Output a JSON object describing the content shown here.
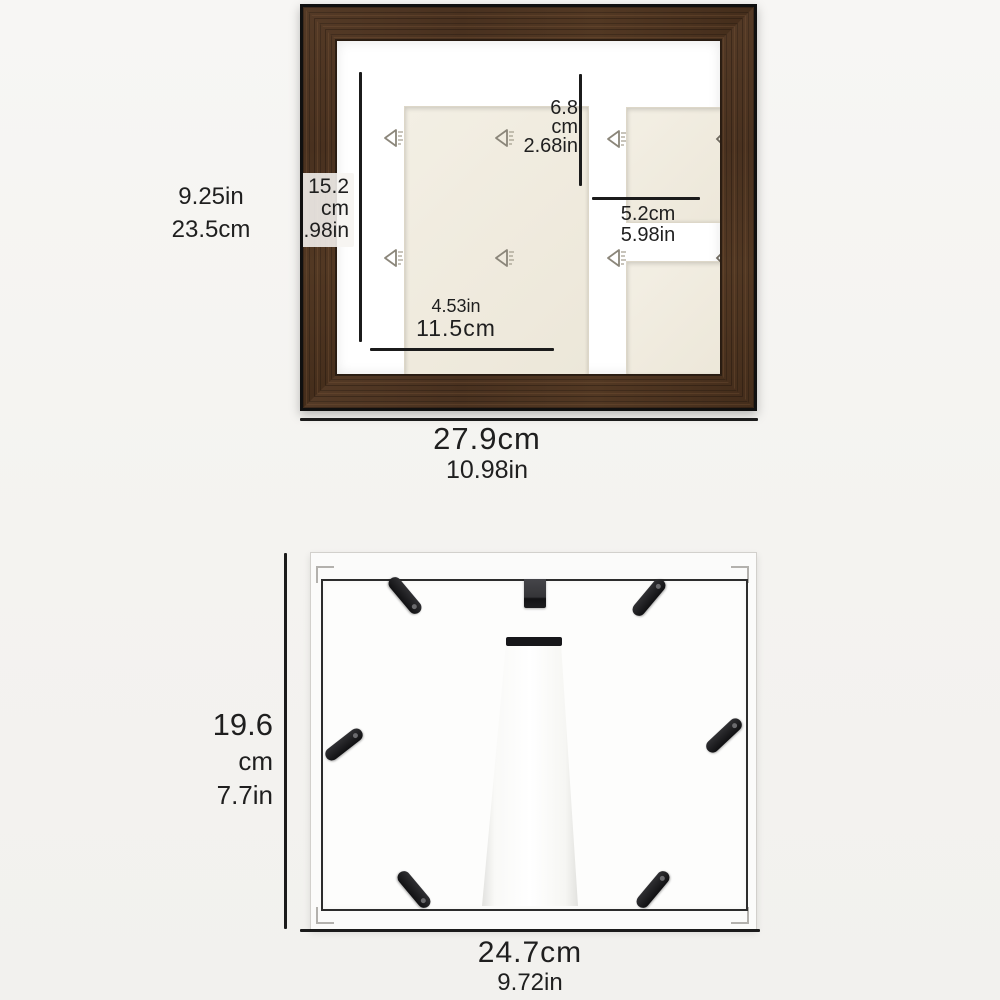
{
  "meta": {
    "description": "Product dimension diagram of a 3-opening rustic brown picture frame: front view and back view with easel stand"
  },
  "colors": {
    "background": "#f5f4f1",
    "wood_brown": "#4a3120",
    "frame_outer_edge": "#101010",
    "mat_white": "#ffffff",
    "insert_cream": "#efeadd",
    "dimension_line": "#1b1b1b",
    "text": "#1f1f1f",
    "hardware_black": "#1d1d1f",
    "back_white": "#fdfdfc"
  },
  "icons": {
    "watermark": "left-triangle-watermark ◁",
    "watermark_partial": "left-chevron ‹",
    "clip": "rotating-tab",
    "hanger": "hanging-hook-tab",
    "easel": "easel-stand-leg"
  },
  "front": {
    "height_in": "9.25in",
    "height_cm": "23.5cm",
    "main_h_1": "15.2",
    "main_h_2": "cm",
    "main_h_3": "5.98in",
    "small_h_1": "6.8",
    "small_h_2": "cm",
    "small_h_3": "2.68in",
    "small_w_cm": "5.2cm",
    "small_w_in": "5.98in",
    "main_w_in": "4.53in",
    "main_w_cm": "11.5cm",
    "width_cm": "27.9cm",
    "width_in": "10.98in"
  },
  "back": {
    "height_1": "19.6",
    "height_2": "cm",
    "height_3": "7.7in",
    "width_cm": "24.7cm",
    "width_in": "9.72in"
  }
}
